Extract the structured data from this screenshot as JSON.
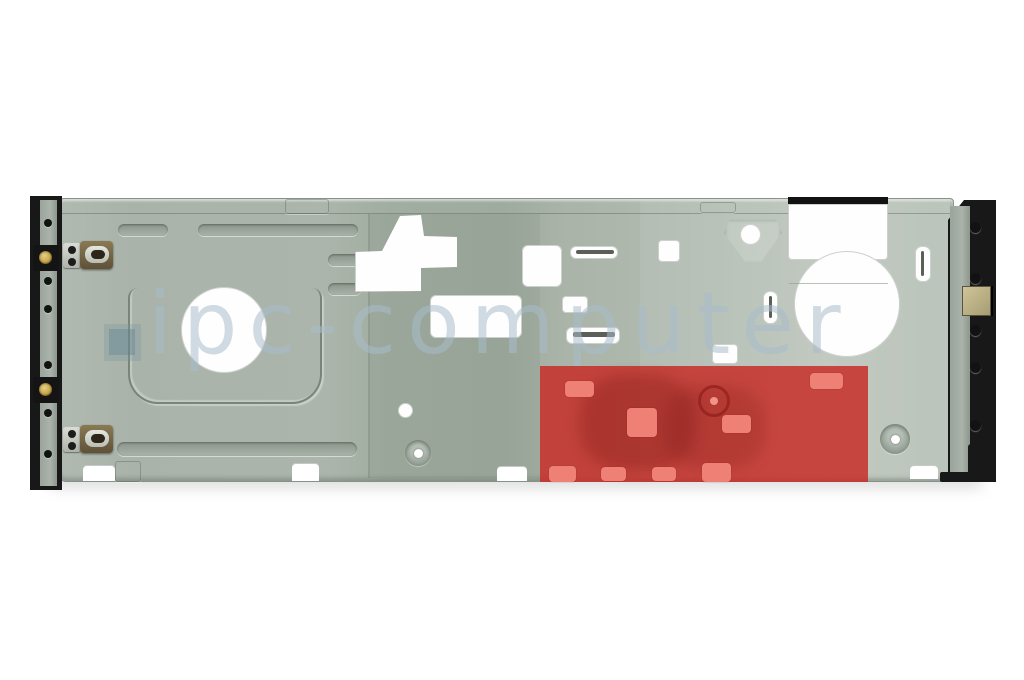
{
  "image": {
    "type": "product-photo",
    "subject": "notebook display rear frame bracket (sheet metal) with a highlighted repair region",
    "background": "#ffffff"
  },
  "watermark": {
    "text": "ipc-computer",
    "logo": "blue-gray-square"
  },
  "highlight": {
    "shape": "rectangle",
    "location": "lower-right of bracket",
    "color": "#c72c26"
  },
  "colors": {
    "plate": "#a9b3a9",
    "plate_light": "#bcc5bc",
    "bezel": "#181818",
    "red": "#c72c26",
    "pink": "#ef8076",
    "gold": "#c9a84c",
    "watermark": "#a8bcc9",
    "cutout": "#ffffff"
  }
}
